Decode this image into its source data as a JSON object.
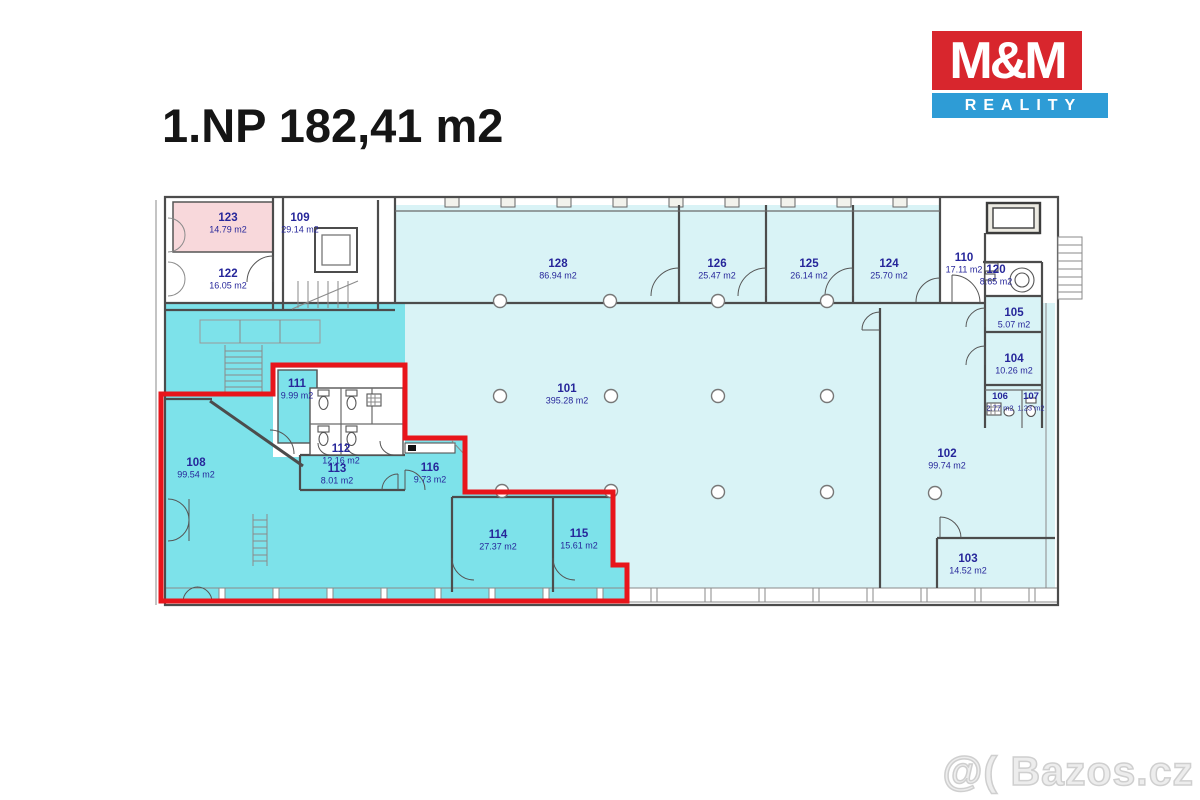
{
  "title": "1.NP 182,41 m2",
  "logo": {
    "line1": "M&M",
    "line2": "REALITY"
  },
  "watermark": "@( Bazos.cz",
  "colors": {
    "highlight_fill": "#7de2ea",
    "room_fill": "#d9f3f6",
    "pink_fill": "#f8d8db",
    "outline_red": "#e8151b",
    "label_blue": "#26269a",
    "logo_red": "#d8262d",
    "logo_blue": "#2e9cd6"
  },
  "rooms": [
    {
      "number": "101",
      "area": "395.28 m2"
    },
    {
      "number": "102",
      "area": "99.74 m2"
    },
    {
      "number": "103",
      "area": "14.52 m2"
    },
    {
      "number": "104",
      "area": "10.26 m2"
    },
    {
      "number": "105",
      "area": "5.07 m2"
    },
    {
      "number": "106",
      "area": "2.77 m2"
    },
    {
      "number": "107",
      "area": "1.23 m2"
    },
    {
      "number": "108",
      "area": "99.54 m2"
    },
    {
      "number": "109",
      "area": "29.14 m2"
    },
    {
      "number": "110",
      "area": "17.11 m2"
    },
    {
      "number": "111",
      "area": "9.99 m2"
    },
    {
      "number": "112",
      "area": "12.16 m2"
    },
    {
      "number": "113",
      "area": "8.01 m2"
    },
    {
      "number": "114",
      "area": "27.37 m2"
    },
    {
      "number": "115",
      "area": "15.61 m2"
    },
    {
      "number": "116",
      "area": "9.73 m2"
    },
    {
      "number": "120",
      "area": "8.65 m2"
    },
    {
      "number": "122",
      "area": "16.05 m2"
    },
    {
      "number": "123",
      "area": "14.79 m2"
    },
    {
      "number": "124",
      "area": "25.70 m2"
    },
    {
      "number": "125",
      "area": "26.14 m2"
    },
    {
      "number": "126",
      "area": "25.47 m2"
    },
    {
      "number": "128",
      "area": "86.94 m2"
    }
  ]
}
